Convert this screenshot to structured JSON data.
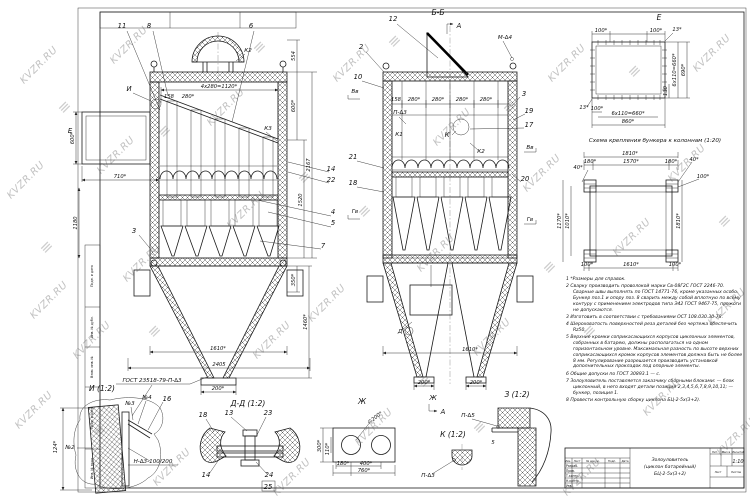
{
  "watermark": {
    "text": "KVZR.RU",
    "logo": "≡"
  },
  "dims": {
    "d1120": "4х280=1120*",
    "d158": "158",
    "d280": "280*",
    "d600": "600*",
    "d710": "710*",
    "d1180": "1180",
    "d554": "554",
    "d2167": "2167",
    "d1520": "1520",
    "d1460": "1460*",
    "d350": "350*",
    "d1610": "1610*",
    "d2405": "2405",
    "d200": "200*",
    "d100": "100*",
    "d13": "13*",
    "d660": "6х110=660*",
    "d690": "690*",
    "d860": "860*",
    "d130": "130",
    "d1810": "1810*",
    "d180": "180*",
    "d1570": "1570*",
    "d40": "40*",
    "d1170": "1170*",
    "d1010": "1010*",
    "d124": "124*",
    "d300": "300*",
    "d110": "110*",
    "d400": "400*",
    "d760": "760*",
    "d5": "5",
    "dia200": "∅200*"
  },
  "marks": {
    "i": "И",
    "e": "Е",
    "bb": "Б-Б",
    "a": "А",
    "k": "К",
    "d": "Д",
    "zh": "Ж",
    "vv": "Вв",
    "gv": "Гв",
    "k1": "К1",
    "k2": "К2",
    "k3": "К3",
    "m4": "М-∆4",
    "p3": "П-∆3",
    "p5": "П-∆5",
    "n2": "№2",
    "n3": "№3",
    "n4": "№4",
    "gost_weld": "ГОСТ 23518-79-П-∆3",
    "weld_h": "Н-∆3-100/200"
  },
  "callouts": {
    "c2": "2",
    "c3": "3",
    "c4": "4",
    "c5": "5",
    "c6": "6",
    "c7": "7",
    "c8": "8",
    "c10": "10",
    "c11": "11",
    "c12": "12",
    "c13": "13",
    "c14": "14",
    "c16": "16",
    "c17": "17",
    "c18": "18",
    "c19": "19",
    "c20": "20",
    "c21": "21",
    "c22": "22",
    "c23": "23",
    "c24": "24",
    "c25": "25"
  },
  "titles": {
    "i": "И (1:2)",
    "dd": "Д-Д (1:2)",
    "z": "З (1:2)",
    "k": "К (1:2)",
    "scheme": "Схема крепления бункера к колоннам (1:20)"
  },
  "notes": {
    "items": [
      "1  *Размеры для справок.",
      "2  Сварку производить проволокой марки Св-08Г2С ГОСТ 2246-70. Сварные швы выполнять по ГОСТ 14771-76, кроме указанных особо. Бункер поз.1 и опору поз. 8 сварить между собой вплотную по всему контуру с применением электродов типа Э42 ГОСТ 9467-75, прожоги не допускаются.",
      "3  Изготовить в соответствии с требованиями ОСТ 108.030.30-78.",
      "4  Шероховатость поверхностей реза деталей без чертежа обеспечить Rz50.",
      "5  Верхние кромки соприкасающихся корпусов циклонных элементов, собранных в батарею, должны располагаться на одном горизонтальном уровне. Максимальная разность по высоте верхних соприкасающихся кромок корпусов элементов должна быть не более 8 мм. Регулирование разрешается производить установкой дополнительных прокладок под опорные элементы.",
      "6  Общие допуски по ГОСТ 30893.1 — с.",
      "7  Золоуловитель поставляется заказчику сборными блоками: — блок циклонный, в него входят детали позиций 2,3,4,5,6,7,8,9,10,11; — бункер, позиция 1.",
      "8  Провести контрольную сборку циклона БЦ-2-5х(3+2)."
    ]
  },
  "stamp": {
    "name1": "Золоуловитель",
    "name2": "(циклон батарейный)",
    "name3": "БЦ-2-5х(3+2)",
    "scale": "1:10",
    "col_izm": "Изм.",
    "col_list": "Лист",
    "col_doc": "№ докум.",
    "col_podp": "Подп.",
    "col_data": "Дата",
    "row1": "Разраб.",
    "row2": "Пров.",
    "row3": "Т.контр.",
    "row4": "Н.контр.",
    "row5": "Утв.",
    "lit": "Лит.",
    "massa": "Масса",
    "masshtab": "Масштаб",
    "list": "Лист",
    "listov": "Листов"
  },
  "margin": {
    "labels": [
      "Подп. и дата",
      "Инв. № дубл.",
      "Взам. инв. №",
      "Подп. и дата",
      "Инв. № подл."
    ]
  }
}
